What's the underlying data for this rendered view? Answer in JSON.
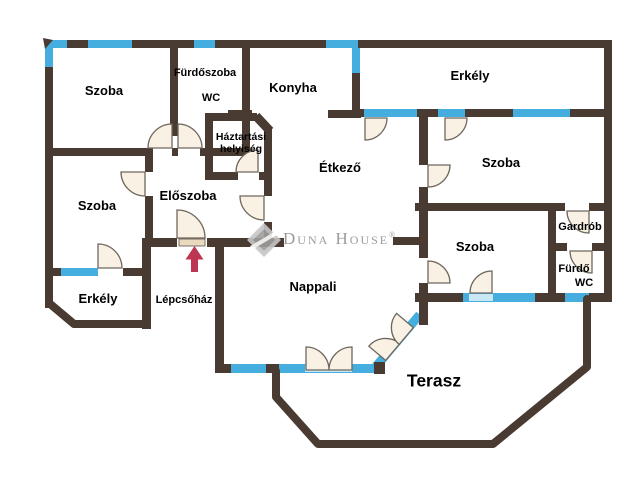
{
  "floorplan": {
    "colors": {
      "wall": "#4a3b32",
      "window": "#45aede",
      "window_light": "#c8e8f6",
      "door_fill": "#f8f1e4",
      "door_stroke": "#6f675e",
      "arrow": "#bc3551",
      "watermark": "#9b9b9b",
      "label": "#000000",
      "background": "#ffffff"
    },
    "rooms": {
      "szoba_top_left": {
        "label": "Szoba"
      },
      "furdoszoba": {
        "label": "Fürdőszoba",
        "label2": "WC"
      },
      "konyha": {
        "label": "Konyha"
      },
      "erkely_top": {
        "label": "Erkély"
      },
      "szoba_right": {
        "label": "Szoba"
      },
      "etkezo": {
        "label": "Étkező"
      },
      "haztartasi": {
        "label": "Háztartási",
        "label2": "helyiség"
      },
      "eloszoba": {
        "label": "Előszoba"
      },
      "szoba_left": {
        "label": "Szoba"
      },
      "gardrob": {
        "label": "Gardrób"
      },
      "szoba_bottom_right": {
        "label": "Szoba"
      },
      "furdo": {
        "label": "Fürdő",
        "label2": "WC"
      },
      "erkely_bottom": {
        "label": "Erkély"
      },
      "lepcsohaz": {
        "label": "Lépcsőház"
      },
      "nappali": {
        "label": "Nappali"
      },
      "terasz": {
        "label": "Terasz"
      }
    },
    "watermark": {
      "brand": "Duna House",
      "registered": "®"
    }
  }
}
